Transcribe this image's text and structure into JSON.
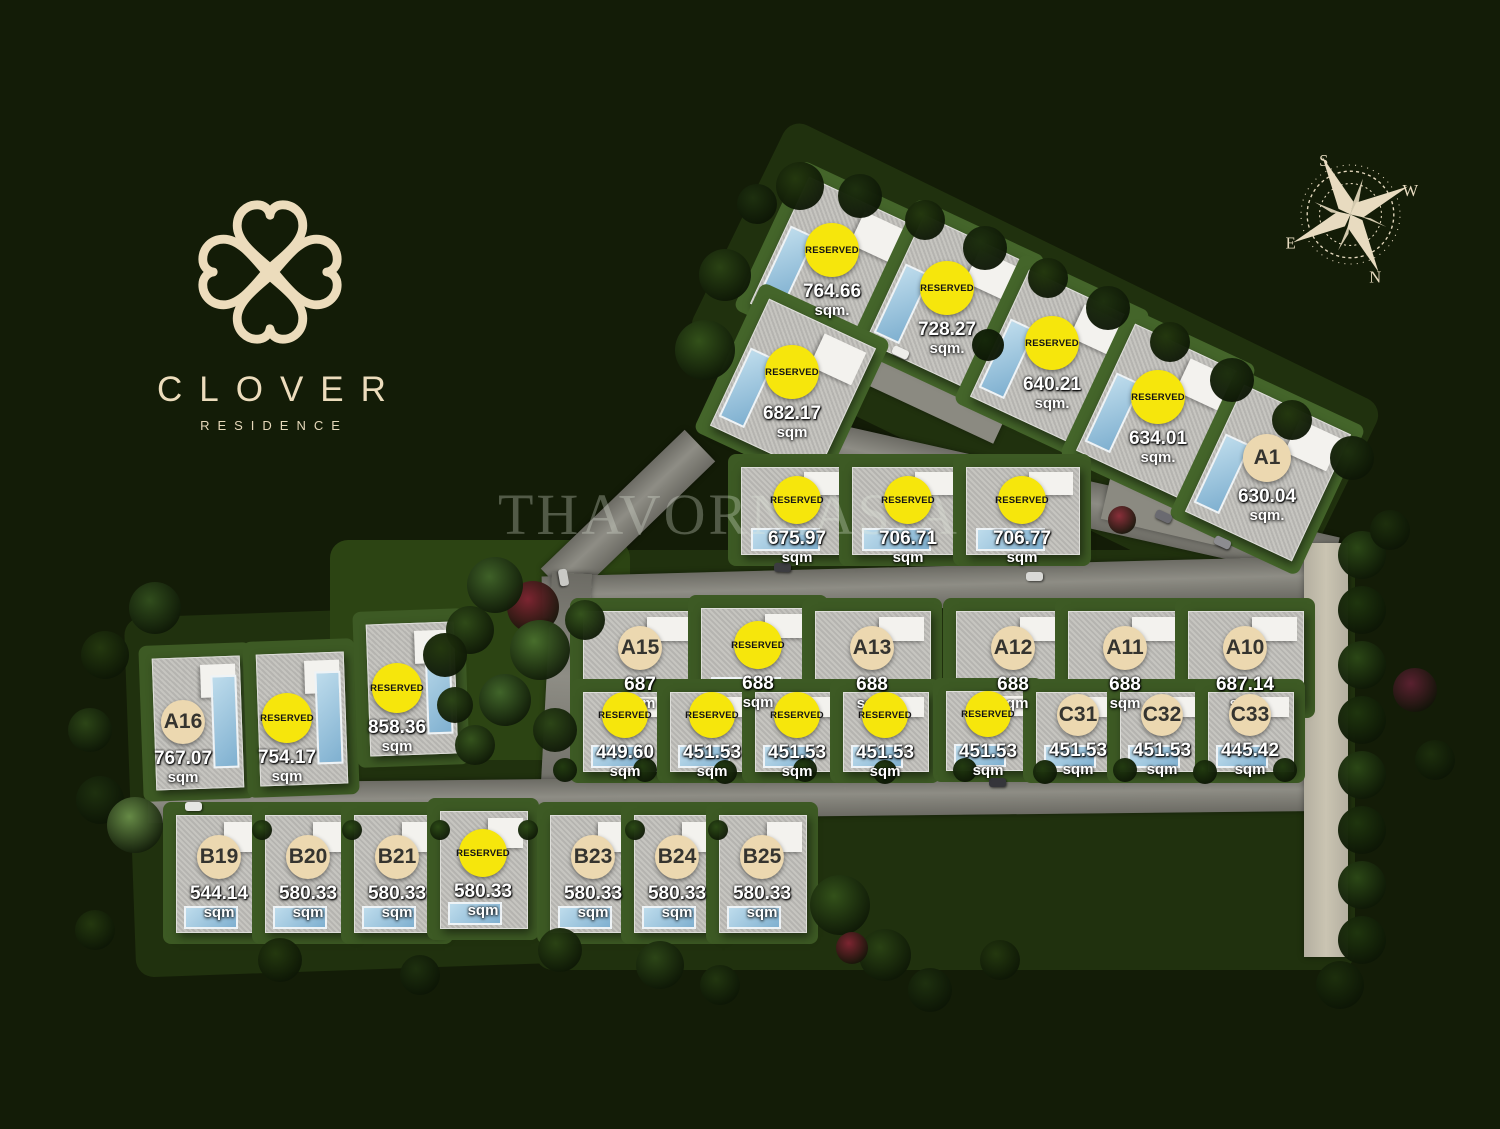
{
  "brand": {
    "name": "CLOVER",
    "subtitle": "RESIDENCE"
  },
  "watermark": "THAVORN.ASIA",
  "compass": {
    "north": "N",
    "south": "S",
    "east": "E",
    "west": "W"
  },
  "colors": {
    "background": "#131c07",
    "reserved_badge": "#f6e60c",
    "unit_badge": "#ecd8b0",
    "area_text": "#ffffff",
    "logo": "#ecdcbc"
  },
  "units": [
    {
      "label": "RESERVED",
      "reserved": true,
      "area": "764.66",
      "area_unit": "sqm.",
      "x": 832,
      "y": 250,
      "group": "top"
    },
    {
      "label": "RESERVED",
      "reserved": true,
      "area": "728.27",
      "area_unit": "sqm.",
      "x": 947,
      "y": 288,
      "group": "top"
    },
    {
      "label": "RESERVED",
      "reserved": true,
      "area": "682.17",
      "area_unit": "sqm",
      "x": 792,
      "y": 372,
      "group": "top"
    },
    {
      "label": "RESERVED",
      "reserved": true,
      "area": "640.21",
      "area_unit": "sqm.",
      "x": 1052,
      "y": 343,
      "group": "top"
    },
    {
      "label": "RESERVED",
      "reserved": true,
      "area": "634.01",
      "area_unit": "sqm.",
      "x": 1158,
      "y": 397,
      "group": "top"
    },
    {
      "label": "A1",
      "reserved": false,
      "area": "630.04",
      "area_unit": "sqm.",
      "x": 1267,
      "y": 458,
      "group": "top"
    },
    {
      "label": "RESERVED",
      "reserved": true,
      "area": "675.97",
      "area_unit": "sqm",
      "x": 797,
      "y": 500,
      "group": "mid"
    },
    {
      "label": "RESERVED",
      "reserved": true,
      "area": "706.71",
      "area_unit": "sqm",
      "x": 908,
      "y": 500,
      "group": "mid"
    },
    {
      "label": "RESERVED",
      "reserved": true,
      "area": "706.77",
      "area_unit": "sqm",
      "x": 1022,
      "y": 500,
      "group": "mid"
    },
    {
      "label": "A15",
      "reserved": false,
      "area": "687",
      "area_unit": "sqm",
      "x": 640,
      "y": 648,
      "group": "arow"
    },
    {
      "label": "RESERVED",
      "reserved": true,
      "area": "688",
      "area_unit": "sqm",
      "x": 758,
      "y": 645,
      "group": "arow"
    },
    {
      "label": "A13",
      "reserved": false,
      "area": "688",
      "area_unit": "sqm",
      "x": 872,
      "y": 648,
      "group": "arow"
    },
    {
      "label": "A12",
      "reserved": false,
      "area": "688",
      "area_unit": "sqm",
      "x": 1013,
      "y": 648,
      "group": "arow"
    },
    {
      "label": "A11",
      "reserved": false,
      "area": "688",
      "area_unit": "sqm",
      "x": 1125,
      "y": 648,
      "group": "arow"
    },
    {
      "label": "A10",
      "reserved": false,
      "area": "687.14",
      "area_unit": "sqm",
      "x": 1245,
      "y": 648,
      "group": "arow"
    },
    {
      "label": "RESERVED",
      "reserved": true,
      "area": "449.60",
      "area_unit": "sqm",
      "x": 625,
      "y": 715,
      "group": "crow"
    },
    {
      "label": "RESERVED",
      "reserved": true,
      "area": "451.53",
      "area_unit": "sqm",
      "x": 712,
      "y": 715,
      "group": "crow"
    },
    {
      "label": "RESERVED",
      "reserved": true,
      "area": "451.53",
      "area_unit": "sqm",
      "x": 797,
      "y": 715,
      "group": "crow"
    },
    {
      "label": "RESERVED",
      "reserved": true,
      "area": "451.53",
      "area_unit": "sqm",
      "x": 885,
      "y": 715,
      "group": "crow"
    },
    {
      "label": "RESERVED",
      "reserved": true,
      "area": "451.53",
      "area_unit": "sqm",
      "x": 988,
      "y": 714,
      "group": "crow"
    },
    {
      "label": "C31",
      "reserved": false,
      "area": "451.53",
      "area_unit": "sqm",
      "x": 1078,
      "y": 715,
      "group": "crow"
    },
    {
      "label": "C32",
      "reserved": false,
      "area": "451.53",
      "area_unit": "sqm",
      "x": 1162,
      "y": 715,
      "group": "crow"
    },
    {
      "label": "C33",
      "reserved": false,
      "area": "445.42",
      "area_unit": "sqm",
      "x": 1250,
      "y": 715,
      "group": "crow"
    },
    {
      "label": "A16",
      "reserved": false,
      "area": "767.07",
      "area_unit": "sqm",
      "x": 183,
      "y": 722,
      "group": "left"
    },
    {
      "label": "RESERVED",
      "reserved": true,
      "area": "754.17",
      "area_unit": "sqm",
      "x": 287,
      "y": 718,
      "group": "left"
    },
    {
      "label": "RESERVED",
      "reserved": true,
      "area": "858.36",
      "area_unit": "sqm",
      "x": 397,
      "y": 688,
      "group": "left"
    },
    {
      "label": "B19",
      "reserved": false,
      "area": "544.14",
      "area_unit": "sqm",
      "x": 219,
      "y": 857,
      "group": "brow"
    },
    {
      "label": "B20",
      "reserved": false,
      "area": "580.33",
      "area_unit": "sqm",
      "x": 308,
      "y": 857,
      "group": "brow"
    },
    {
      "label": "B21",
      "reserved": false,
      "area": "580.33",
      "area_unit": "sqm",
      "x": 397,
      "y": 857,
      "group": "brow"
    },
    {
      "label": "RESERVED",
      "reserved": true,
      "area": "580.33",
      "area_unit": "sqm",
      "x": 483,
      "y": 853,
      "group": "brow"
    },
    {
      "label": "B23",
      "reserved": false,
      "area": "580.33",
      "area_unit": "sqm",
      "x": 593,
      "y": 857,
      "group": "brow"
    },
    {
      "label": "B24",
      "reserved": false,
      "area": "580.33",
      "area_unit": "sqm",
      "x": 677,
      "y": 857,
      "group": "brow"
    },
    {
      "label": "B25",
      "reserved": false,
      "area": "580.33",
      "area_unit": "sqm",
      "x": 762,
      "y": 857,
      "group": "brow"
    }
  ]
}
